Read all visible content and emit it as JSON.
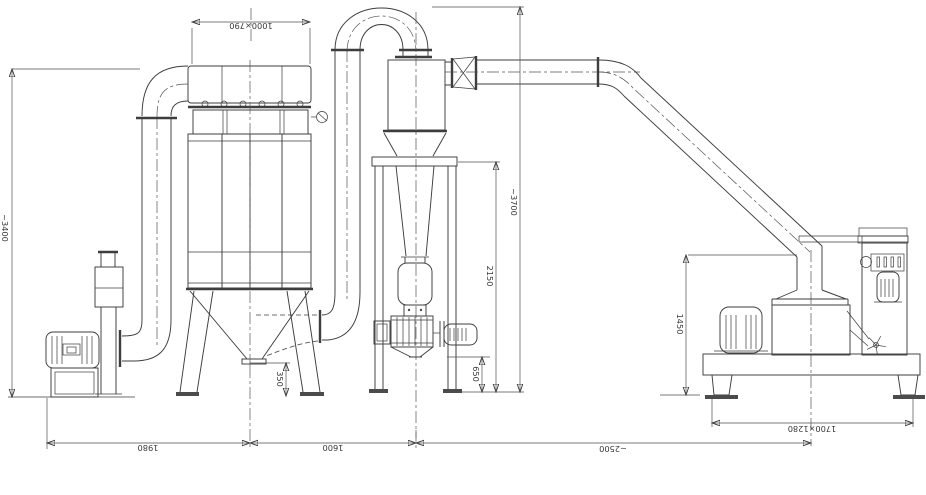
{
  "drawing": {
    "type": "technical-cad-layout-pulverizer-system",
    "colors": {
      "line": "#3d3d3d",
      "dimension": "#4f4f4f",
      "background": "#ffffff"
    },
    "dims": {
      "filter_top": "1000×790",
      "left_height": "~3400",
      "total_height": "~3700",
      "frame_height": "2150",
      "valve_clearance": "650",
      "hopper_clearance": "350",
      "mill_inlet_height": "1450",
      "span_fan_filter": "1980",
      "span_filter_cyclone": "1600",
      "span_cyclone_mill": "~2500",
      "mill_footprint": "1700×1280"
    }
  }
}
